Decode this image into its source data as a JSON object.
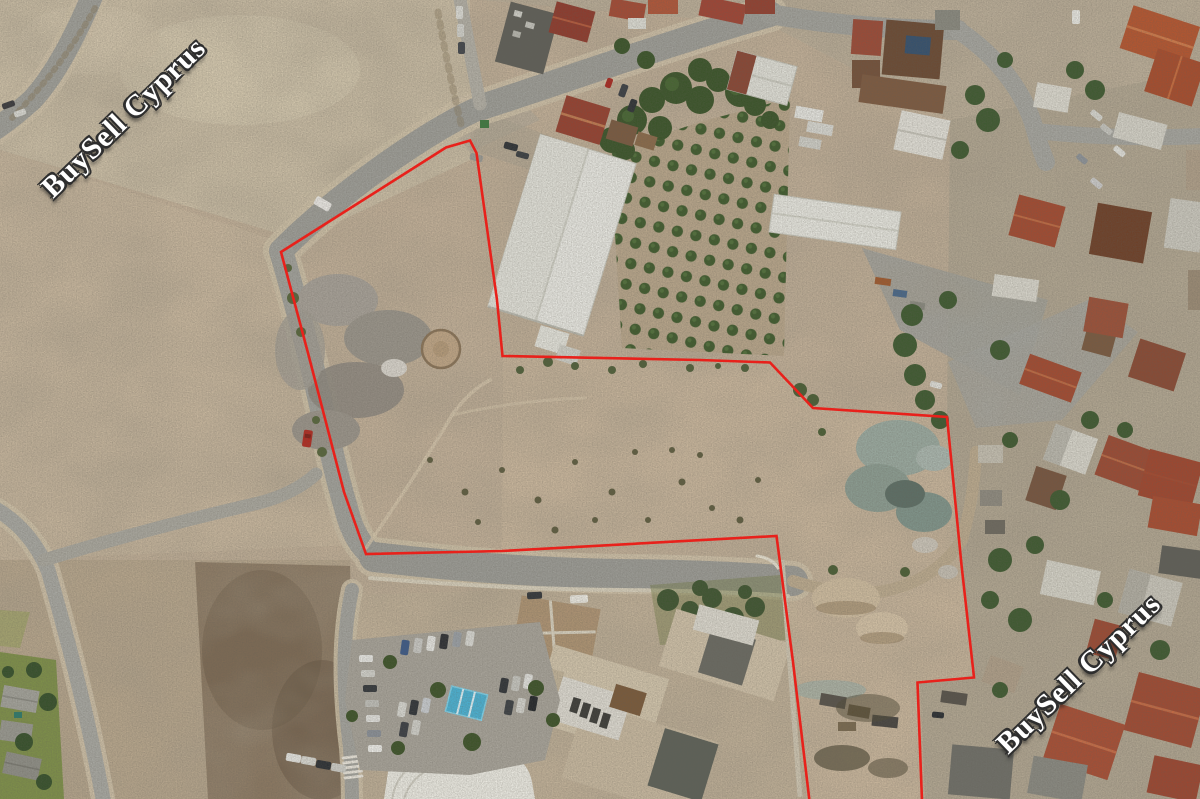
{
  "image": {
    "kind": "aerial-drone-photograph",
    "subject": "Aerial view of land plots outlined in red next to village streets, an orchard, white warehouses, a school with a car park, and open sandy fields"
  },
  "watermarks": {
    "top_left": {
      "text": "BuySell Cyprus"
    },
    "bottom_right": {
      "text": "BuySell Cyprus"
    },
    "text_color": "#ffffff",
    "outline_color": "#2e2e2e"
  },
  "overlay": {
    "boundary_color": "#e8211b",
    "boundary_width_px": "2.6"
  },
  "palette": {
    "sand": "#c3b199",
    "asphalt": "#9e9e98",
    "terracotta_roof": "#a04a32",
    "white_roof": "#e9e9e2",
    "vegetation": "#3f5b2d",
    "lawn": "#7e9049",
    "canopy_blue": "#4ab2d4"
  }
}
